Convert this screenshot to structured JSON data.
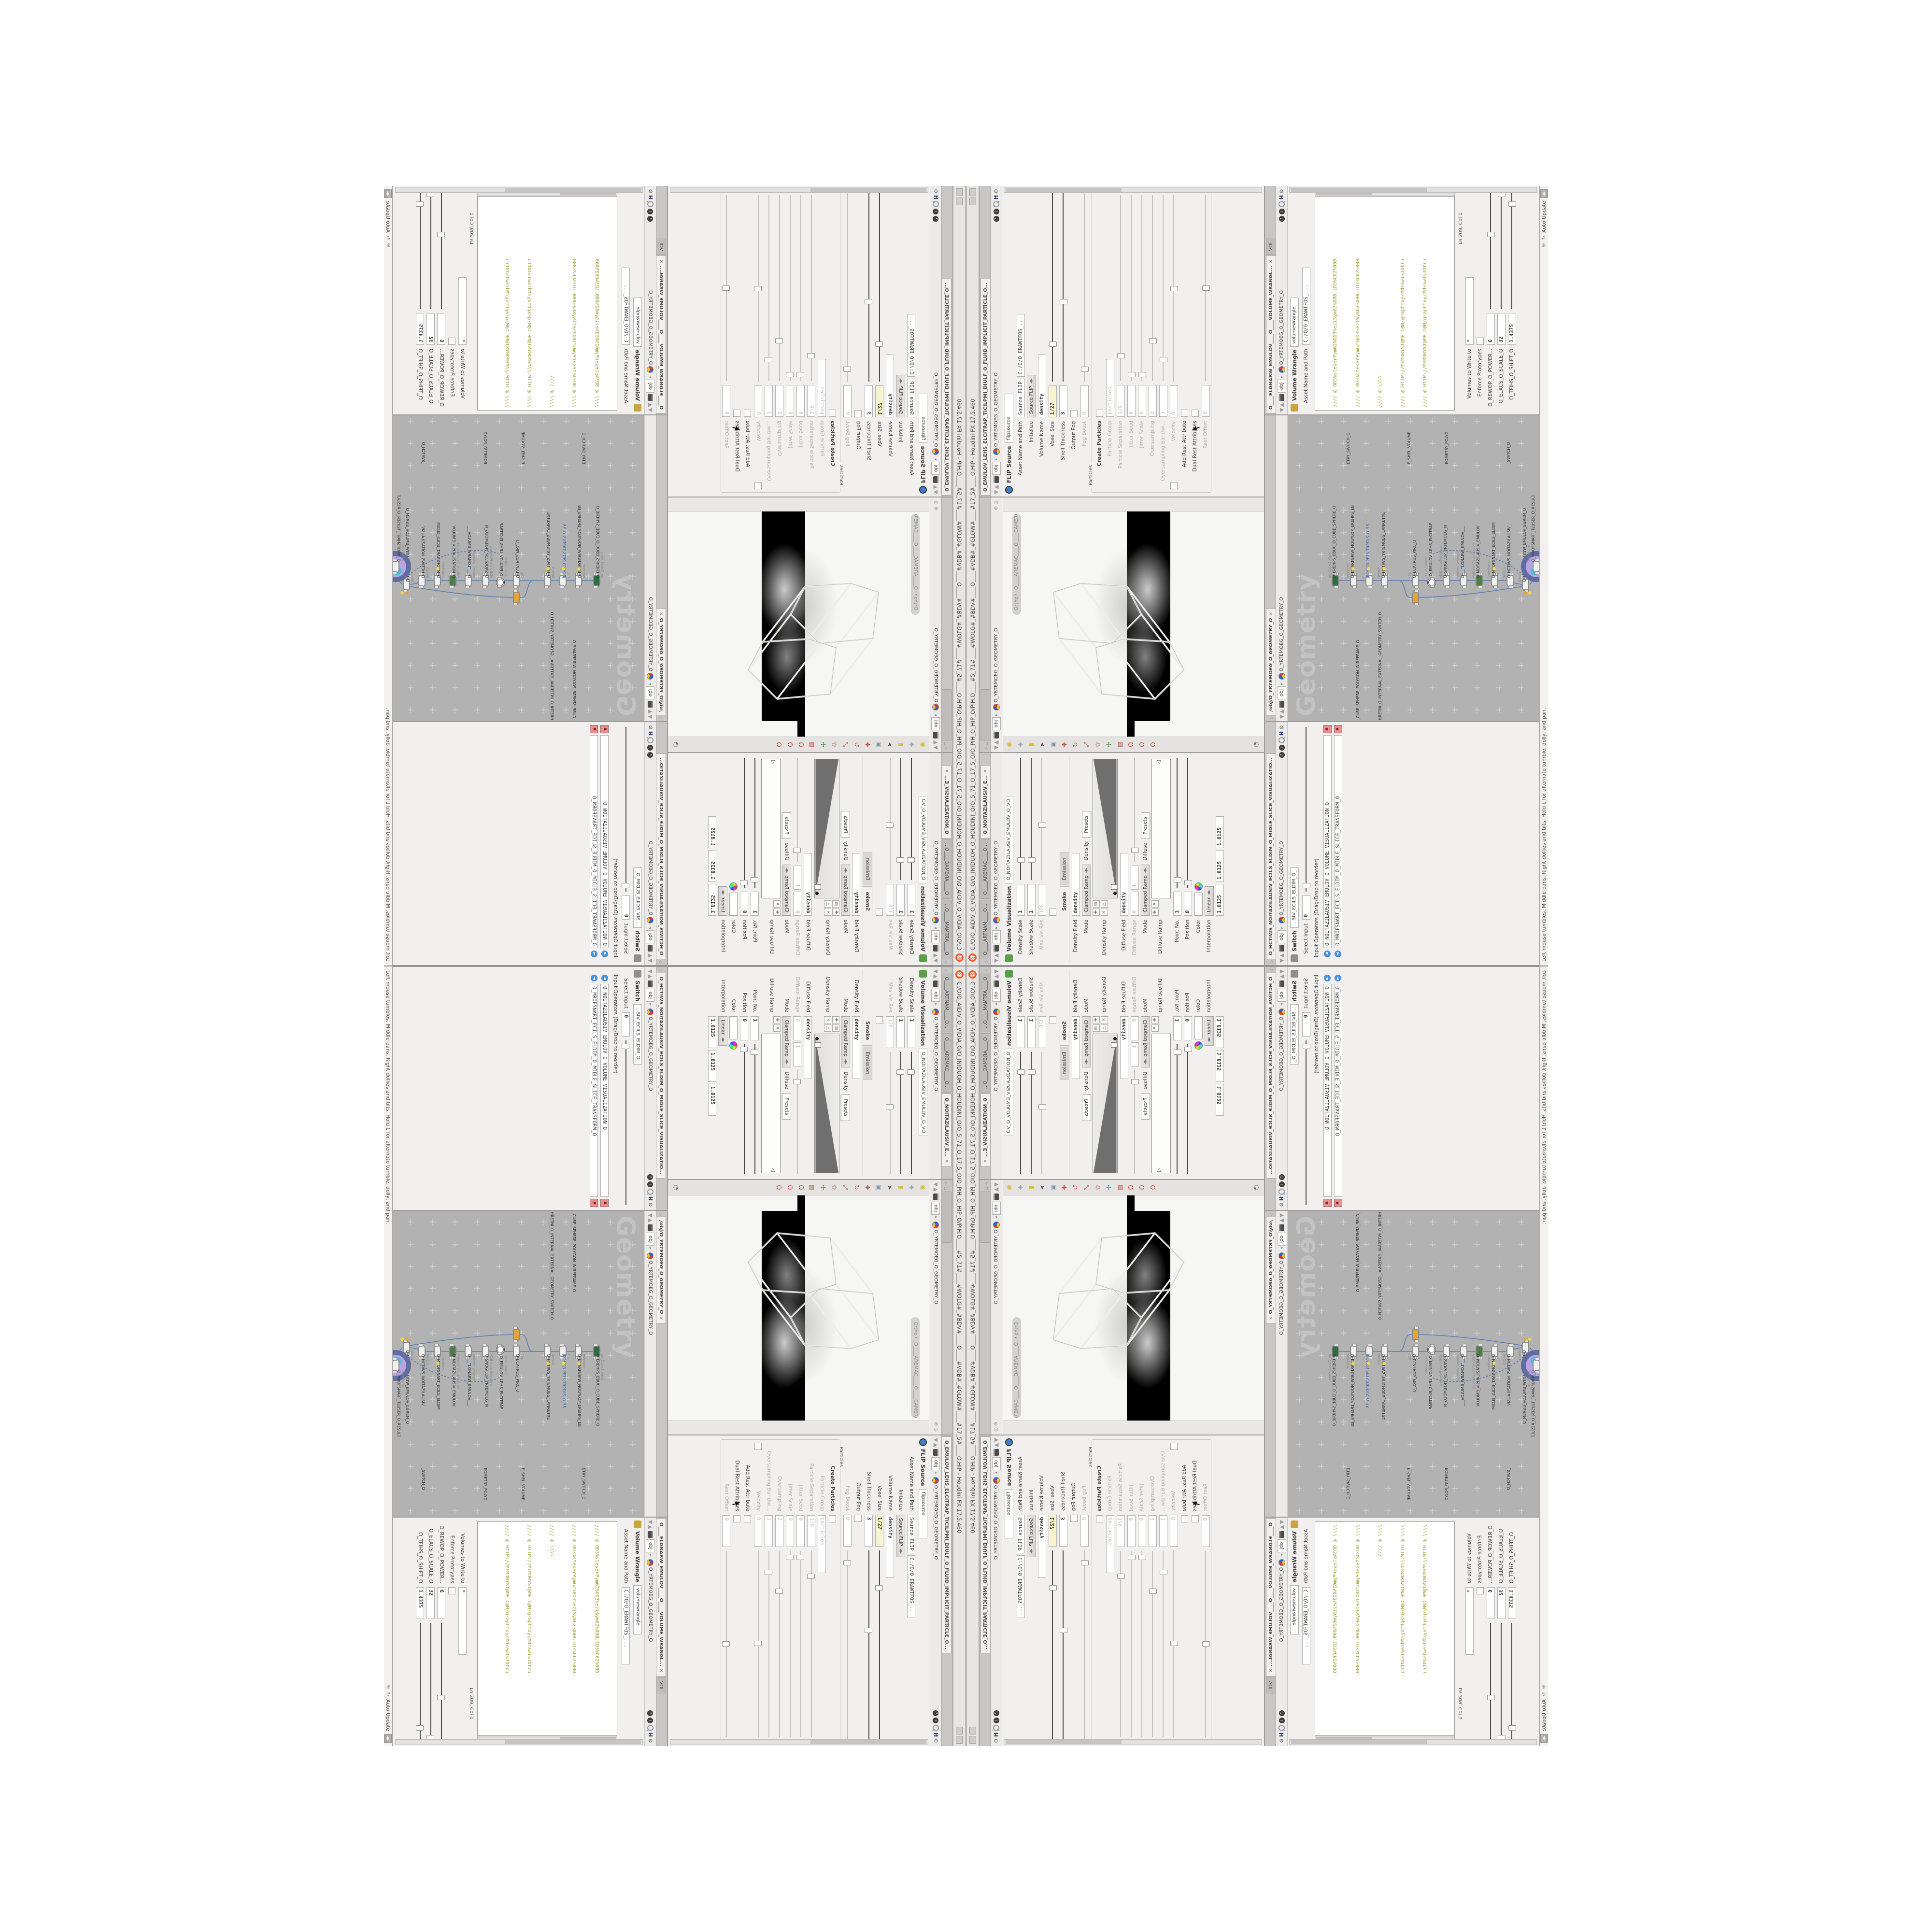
{
  "window": {
    "title": "C:/O/O_AIDIV_O_VIDIA_O/O_INIDUOH_O_HOUDINI_O/O_5_71_O_17_5_O/O_PIH_O_HIP_O/PIH.O____#5_71#____#WOLG#_#BDV#____O____#VDB#_#GLOW#____#17_5#____O.HIP - Houdini FX 17.5.460",
    "logo_glyph": "@"
  },
  "crumb": {
    "obj": "obj",
    "path": "O_YRTEMOEG_O_GEOMETRY_O",
    "sep": "▸",
    "up": "▲",
    "down": "▼"
  },
  "paneicons": {
    "help": "?",
    "info": "i",
    "hscript": "H",
    "gear": "⚙"
  },
  "vv": {
    "tabs": [
      "O____ARTNAM____O...",
      "O____AREMAC____O...",
      "O_NOITAZILAUSIV_E..."
    ],
    "close": "✕",
    "title": "Volume Visualization",
    "name": "O_NOITAZILAUSIV_EMULOV_O_VO",
    "density_scale": {
      "label": "Density Scale",
      "value": "1"
    },
    "shadow_scale": {
      "label": "Shadow Scale",
      "value": "1"
    },
    "max_vis_res": {
      "label": "Max Vis Res",
      "value": "128"
    },
    "foldertabs": [
      "Smoke",
      "Emission"
    ],
    "density_field": {
      "label": "Density Field",
      "value": "density"
    },
    "mode1": {
      "label": "Mode",
      "value": "Clamped Ramp",
      "field": "Density",
      "presets": "Presets"
    },
    "density_ramp": {
      "label": "Density Ramp"
    },
    "diffuse_field": {
      "label": "Diffuse Field",
      "value": "density"
    },
    "diffuse_range": {
      "label": "Diffuse Range",
      "v1": "0",
      "v2": "1"
    },
    "mode2": {
      "label": "Mode",
      "value": "Clamped Ramp",
      "field": "Diffuse",
      "presets": "Presets"
    },
    "diffuse_ramp": {
      "label": "Diffuse Ramp"
    },
    "point_no": {
      "label": "Point No.",
      "value": "1"
    },
    "position": {
      "label": "Position",
      "value": "0"
    },
    "color": {
      "label": "Color"
    },
    "interpolation": {
      "label": "Interpolation",
      "value": "Linear"
    },
    "triple": {
      "v1": "1.8125",
      "v2": "1.8125",
      "v3": "1.8125"
    }
  },
  "viewport": {
    "pills": {
      "ortho": "Ortho ▾",
      "camera": "O____AREMAC____O____CAMERA_"
    },
    "toolbar": [
      {
        "name": "lamp-icon",
        "glyph": "◉",
        "color": "#d8b93a"
      },
      {
        "name": "shade-diamond-icon",
        "glyph": "◈",
        "color": "#8fa3b5"
      },
      {
        "name": "material-book-icon",
        "glyph": "▮",
        "color": "#d8b93a"
      },
      {
        "name": "select-arrow-icon",
        "glyph": "➤",
        "color": "#5a5a5a"
      },
      {
        "name": "box-select-icon",
        "glyph": "▣",
        "color": "#7d96a8"
      },
      {
        "name": "move-icon",
        "glyph": "✥",
        "color": "#c24a3e"
      },
      {
        "name": "rotate-icon",
        "glyph": "↻",
        "color": "#c24a3e"
      },
      {
        "name": "scale-icon",
        "glyph": "⤢",
        "color": "#c24a3e"
      },
      {
        "name": "pose-icon",
        "glyph": "✿",
        "color": "#c9a0a0"
      },
      {
        "name": "axis-icon",
        "glyph": "✣",
        "color": "#4e9e4e"
      },
      {
        "name": "snap-grid-icon",
        "glyph": "▦",
        "color": "#c24a3e"
      },
      {
        "name": "snap-point-icon",
        "glyph": "Ω",
        "color": "#c24a3e"
      },
      {
        "name": "snap-prim-icon",
        "glyph": "Ω",
        "color": "#c24a3e"
      },
      {
        "name": "snap-multi-icon",
        "glyph": "Ω",
        "color": "#c24a3e"
      },
      {
        "name": "flipbook-icon",
        "glyph": "◔",
        "color": "#6f6f6f"
      }
    ]
  },
  "flip": {
    "tab": "O_EMULOV_LEHS_ELCITRAP_TICILPMI_DIULF_O_FLUID_IMPLICIT_PARTICLE_O...",
    "title": "FLIP Source",
    "name": "flipsource",
    "asset": {
      "label": "Asset Name and Path",
      "name": "Source FLIP",
      "path": "C:/O/O_ERAWTFOS_..."
    },
    "initialize": {
      "label": "Initialize",
      "value": "Source FLIP"
    },
    "volume_name": {
      "label": "Volume Name",
      "value": "density"
    },
    "voxel_size": {
      "label": "Voxel Size",
      "value": "1/27"
    },
    "shell_thickness": {
      "label": "Shell Thickness",
      "value": "3"
    },
    "output_fog": {
      "label": "Output Fog"
    },
    "fog_boost": {
      "label": "Fog Boost",
      "value": "0"
    },
    "particles_group": "Particles",
    "create_particles": {
      "label": "Create Particles"
    },
    "particle_group": {
      "label": "Particle Group",
      "value": "particles"
    },
    "particle_separation": {
      "label": "Particle Separation",
      "value": "1/9"
    },
    "jitter_seed": {
      "label": "Jitter Seed",
      "value": "0"
    },
    "jitter_scale": {
      "label": "Jitter Scale",
      "value": "0"
    },
    "oversampling": {
      "label": "Oversampling",
      "value": "2"
    },
    "oversampling_bw": {
      "label": "Oversampling Bandwi...",
      "value": "1"
    },
    "velocity": {
      "label": "Velocity",
      "value": "0"
    },
    "add_rest": {
      "label": "Add Rest Attribute"
    },
    "dual_rest": {
      "label": "Dual Rest Attributes"
    },
    "rest_offset": {
      "label": "Rest Offset",
      "value": "0"
    }
  },
  "switch": {
    "tab": "O_HCTIWS_NOITAZILAUSIV_ECILS_ELDIM_O_MIDLE_SLICE_VISUALIZATIO...",
    "title": "Switch",
    "name": "...SIV_ECILS_ELDIM_O_",
    "select_input": {
      "label": "Select Input",
      "value": "0"
    },
    "operators_label": "Input Operators (Drag/Drop to reorder)",
    "items": [
      "O_NOITAZILAUSIV_EMULOV_O_VOLUME_VISUALIZATION_O",
      "O_MROFSNART_ECILS_ELDIM_O_MIDLE_SLICE_TRANSFORM_O"
    ]
  },
  "network": {
    "tab": "/obj/O_YRTEMOEG_O_GEOMETRY_O",
    "watermark": "Geometry",
    "nodes": [
      {
        "type": "an_CubeSphere",
        "name": "O_EREHPS_EBUC_O_CUBE_SPHERE_O"
      },
      {
        "type": "PolyWire",
        "name": "O_EMARFERIW_NOGYLOP_EREHPS_EB"
      },
      {
        "type": "File",
        "name": "JBO%03.PETS.TRPDLS_O_55"
      },
      {
        "type": "Switch",
        "name": "O_HCTIWS_YRTEMOEG_LANRETXE"
      },
      {
        "type": "Clip",
        "name": "O_ECAFRUS_PIRC_O"
      },
      {
        "type": "FLIP Source",
        "name": "O_EMULOV_LEHS_ELCITRAP"
      },
      {
        "type": "VDB from Polygons",
        "name": "O_SNOGILOP_YRTEMOEG_N"
      },
      {
        "type": "Volume Wrangle",
        "name": "O___ELGNARW_EMULOV___"
      },
      {
        "type": "Volume Visualization",
        "name": "O_NOITAZILAUSIV_EMULOV"
      },
      {
        "type": "Transform",
        "name": "O_MROFSNART_ECILS_ELDIM"
      },
      {
        "type": "Switch",
        "name": "O_HCTIWS_NOITAZILAUSIV_"
      },
      {
        "type": "Merge",
        "name": "O_ECAFRUS_HTIW_EMULOV_EGREM_O"
      },
      {
        "type": "Transform",
        "name": "O_MROFSNART_TLUSER_O_RESULT"
      }
    ],
    "labels": {
      "l1": "_CUBE_SPHERE_POLYGON_WIREFRAME_O",
      "l2": "HRETNI_O_INTERNAL_EXTERNAL_GEOMETRY_SWITCH_O",
      "l3": "ETRY_SWITCH_O",
      "l4": "E_SHEL_VOLUME",
      "l5": "EOMETRY_POLYG",
      "l6": "_SWITCH_O"
    }
  },
  "wrangle": {
    "tab": "O____ELGNARW_EMULOV____O____VOLUME_WRANGL...",
    "tab2": "VOl",
    "title": "Volume Wrangle",
    "name": "volumewrangle",
    "asset": {
      "label": "Asset Name and Path",
      "path": "C:/O/O_ERAWTFOS_..."
    },
    "code": {
      "l1": "//// @ 0D3%steserPym62%0D3%eziSym62%000.1D3%C62%000.",
      "l2": "//// @ 0D3%steserPym62%0D3%eziSym62%000.1D3%C62%000.",
      "l3": "//// @ \\\\\\\\",
      "l4": "//// @ HTTP://MEMORYST@MP.C@M/graphtoy/#draw1%3Dtru",
      "l5": "//// @ HTTP://MEMORYST@MP.C@M/graphtoy/#draw1%3Dtru",
      "l6": "",
      "l7a": "@density=((          ((",
      "l7b": "pow",
      "l7c": "((      1./ (1.-cla",
      "l8": "",
      "l9": "//// @ 0D3%steserPym62%0D3%eziSym62%000.1D3%C62%000.",
      "l10": "//// @ 0D3%steserPym62%0D3%eziSym62%000.1D3%C62%000.",
      "l11": "//// @ \\\\\\\\",
      "l12": "//// @ HTTP://MEMORYST@MP.C@M/graphtoy/#draw1%3Dtru",
      "l13": "//// @ HTTP://MEMORYST@MP.C@M/graphtoy/#draw1%3Dtru"
    },
    "lncol": "Ln 209, Col 1",
    "volumes": {
      "label": "Volumes to Write to",
      "value": "*"
    },
    "enforce": {
      "label": "Enforce Prototypes"
    },
    "power": {
      "label": "O_REWOP_O_POWER...",
      "value": "6"
    },
    "scale": {
      "label": "O_ELACS_O_SCALE_O",
      "value": "32"
    },
    "shift": {
      "label": "O_TFIHS_O_SHIFT_O",
      "value": "1.4375"
    }
  },
  "statusbar": {
    "hint": "Left mouse tumbles.  Middle pans.  Right dollies and tilts.  Hold L for alternate tumble, dolly, and pan.",
    "auto_update": "Auto Update"
  },
  "colors": {
    "accent_orange": "#f05a28",
    "code_olive": "#9a9a2e",
    "wire_blue": "#5b7db1",
    "select_purple": "#b7a4e0",
    "flag_yellow": "#ecd64a",
    "expr_yellow": "#f7f4cf",
    "network_bg": "#b2b2b2"
  }
}
